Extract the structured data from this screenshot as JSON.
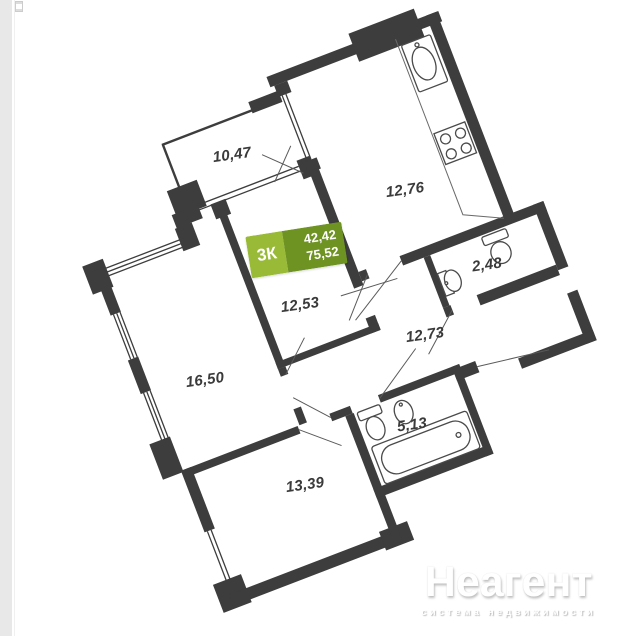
{
  "page": {
    "background_color": "#ffffff",
    "left_strip_color": "#e8e8e8"
  },
  "artifacts": {
    "broken_image_icon": "broken-image-placeholder"
  },
  "floor_plan": {
    "kind": "apartment-floor-plan",
    "rotation_deg": -21,
    "wall_color": "#3d3d3d",
    "badge": {
      "room_count": "3К",
      "living_area": "42,42",
      "total_area": "75,52",
      "left_color": "#98ba36",
      "right_color": "#6e9322"
    },
    "rooms": [
      {
        "id": "loggia",
        "area": "10,47",
        "label_x": 232,
        "label_y": 155
      },
      {
        "id": "kitchen",
        "area": "12,76",
        "label_x": 405,
        "label_y": 190
      },
      {
        "id": "wc-small",
        "area": "2,48",
        "label_x": 487,
        "label_y": 265
      },
      {
        "id": "bedroom-1",
        "area": "12,53",
        "label_x": 300,
        "label_y": 305
      },
      {
        "id": "hallway",
        "area": "12,73",
        "label_x": 425,
        "label_y": 335
      },
      {
        "id": "living-room",
        "area": "16,50",
        "label_x": 205,
        "label_y": 380
      },
      {
        "id": "bathroom",
        "area": "5,13",
        "label_x": 412,
        "label_y": 425
      },
      {
        "id": "bedroom-2",
        "area": "13,39",
        "label_x": 305,
        "label_y": 485
      }
    ]
  },
  "watermark": {
    "brand": "Неагент",
    "tagline": "система недвижимости"
  }
}
